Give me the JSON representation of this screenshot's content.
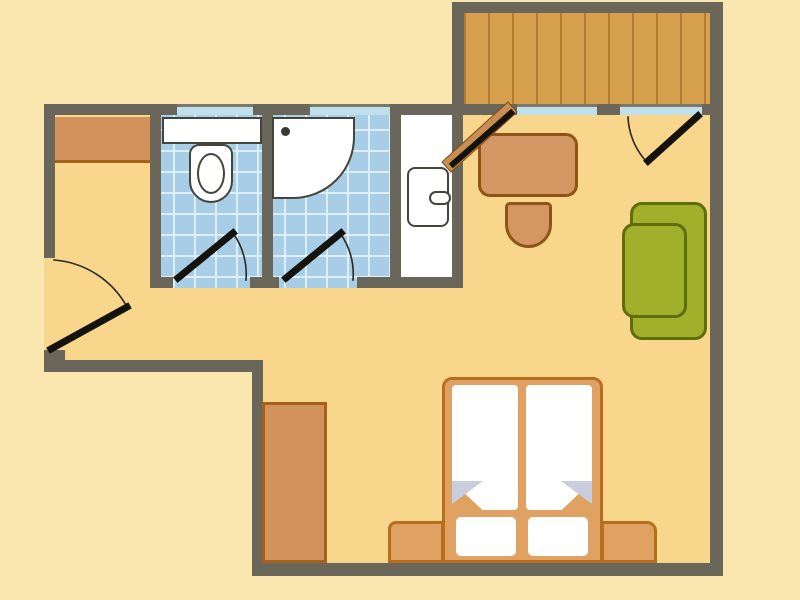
{
  "colors": {
    "outside": "#FAE7AF",
    "floor": "#F8D78C",
    "wall": "#6A675A",
    "window": "#BFE0EB",
    "tile": "#A7CDE7",
    "tile_line": "#DCEFFA",
    "wood": "#D7A04F",
    "wood_line": "#B07C2F",
    "white": "#FFFFFF",
    "fixture_outline": "#45443C",
    "furniture_orange": "#D2935B",
    "furniture_outline": "#A5611C",
    "desk_fill": "#D49663",
    "desk_outline": "#8F5516",
    "bed_frame": "#DFA263",
    "bed_outline": "#B96E1F",
    "sofa_green": "#A0B02A",
    "sofa_outline": "#5F6D0D",
    "door_leaf": "#15130D",
    "arc": "#2A2820",
    "fold": "#C9CEDE",
    "door_panel": "#C98E52",
    "door_panel_outline": "#7A4B15"
  },
  "floor_plan": {
    "rooms": [
      {
        "name": "apartment-floor",
        "surface": "",
        "x": 0,
        "y": 0,
        "w": 800,
        "h": 600,
        "fill": "floor",
        "style": {
          "clipPath": "polygon(55px 115px, 714px 115px, 714px 566px, 252px 566px, 252px 360px, 55px 360px, 55px 350px, 44px 350px, 44px 258px, 55px 258px)"
        }
      },
      {
        "name": "wc-room-tiles",
        "surface": "tiles",
        "x": 161,
        "y": 115,
        "w": 101,
        "h": 173
      },
      {
        "name": "shower-room-tiles",
        "surface": "tiles",
        "x": 272,
        "y": 115,
        "w": 118,
        "h": 173
      },
      {
        "name": "vanity-room",
        "surface": "",
        "x": 401,
        "y": 115,
        "w": 51,
        "h": 173,
        "fill": "white"
      },
      {
        "name": "balcony-deck",
        "surface": "wood",
        "x": 464,
        "y": 13,
        "w": 246,
        "h": 91
      }
    ],
    "walls": [
      {
        "name": "wall-top-left-a",
        "x": 44,
        "y": 104,
        "w": 133,
        "h": 11
      },
      {
        "name": "wall-top-nub-1",
        "x": 253,
        "y": 104,
        "w": 57,
        "h": 11
      },
      {
        "name": "wall-top-left-b",
        "x": 390,
        "y": 104,
        "w": 76,
        "h": 11
      },
      {
        "name": "wall-room-top-a",
        "x": 466,
        "y": 104,
        "w": 51,
        "h": 11
      },
      {
        "name": "wall-room-top-nub",
        "x": 597,
        "y": 104,
        "w": 23,
        "h": 11
      },
      {
        "name": "wall-room-top-b",
        "x": 702,
        "y": 104,
        "w": 21,
        "h": 11
      },
      {
        "name": "wall-balcony-top",
        "x": 455,
        "y": 2,
        "w": 268,
        "h": 11
      },
      {
        "name": "wall-balcony-left",
        "x": 452,
        "y": 2,
        "w": 12,
        "h": 102
      },
      {
        "name": "wall-right",
        "x": 710,
        "y": 2,
        "w": 13,
        "h": 574
      },
      {
        "name": "wall-left",
        "x": 44,
        "y": 104,
        "w": 11,
        "h": 154
      },
      {
        "name": "wall-entry-stub",
        "x": 44,
        "y": 350,
        "w": 21,
        "h": 22
      },
      {
        "name": "wall-hall-bottom",
        "x": 44,
        "y": 360,
        "w": 219,
        "h": 12
      },
      {
        "name": "wall-mid-vertical",
        "x": 252,
        "y": 360,
        "w": 11,
        "h": 213
      },
      {
        "name": "wall-bottom",
        "x": 252,
        "y": 563,
        "w": 471,
        "h": 13
      },
      {
        "name": "wall-bath-left",
        "x": 150,
        "y": 115,
        "w": 11,
        "h": 173
      },
      {
        "name": "wall-wc-shower",
        "x": 262,
        "y": 115,
        "w": 11,
        "h": 173
      },
      {
        "name": "wall-shower-vanity",
        "x": 390,
        "y": 115,
        "w": 11,
        "h": 173
      },
      {
        "name": "wall-vanity-right",
        "x": 452,
        "y": 115,
        "w": 11,
        "h": 173
      },
      {
        "name": "wall-bath-bottom-a",
        "x": 150,
        "y": 277,
        "w": 23,
        "h": 11
      },
      {
        "name": "wall-bath-bottom-b",
        "x": 250,
        "y": 277,
        "w": 29,
        "h": 11
      },
      {
        "name": "wall-bath-bottom-c",
        "x": 357,
        "y": 277,
        "w": 106,
        "h": 11
      }
    ],
    "windows": [
      {
        "name": "window-wc",
        "x": 177,
        "y": 104,
        "w": 76,
        "h": 11
      },
      {
        "name": "window-shower",
        "x": 310,
        "y": 104,
        "w": 80,
        "h": 11
      },
      {
        "name": "window-balcony-left",
        "x": 517,
        "y": 104,
        "w": 80,
        "h": 11
      },
      {
        "name": "window-balcony-right",
        "x": 620,
        "y": 104,
        "w": 82,
        "h": 11
      }
    ],
    "furniture": [
      {
        "name": "hall-wardrobe",
        "x": 55,
        "y": 117,
        "w": 95,
        "h": 46,
        "fill": "furniture_orange",
        "style": {
          "borderBottom": "3px solid #A5611C"
        }
      },
      {
        "name": "wc-cistern",
        "x": 162,
        "y": 117,
        "w": 100,
        "h": 27,
        "fill": "white",
        "style": {
          "border": "2px solid #45443C"
        }
      },
      {
        "name": "toilet-body",
        "x": 189,
        "y": 144,
        "w": 44,
        "h": 59,
        "fill": "white",
        "style": {
          "border": "2.5px solid #45443C",
          "borderRadius": "10px 10px 22px 22px"
        }
      },
      {
        "name": "toilet-bowl",
        "x": 197,
        "y": 153,
        "w": 28,
        "h": 41,
        "fill": "white",
        "style": {
          "border": "2.5px solid #45443C",
          "borderRadius": "50%"
        }
      },
      {
        "name": "shower-tray",
        "x": 272,
        "y": 117,
        "w": 83,
        "h": 82,
        "fill": "white",
        "style": {
          "border": "2.5px solid #45443C",
          "borderBottomRightRadius": "62px"
        }
      },
      {
        "name": "shower-drain",
        "x": 281,
        "y": 127,
        "w": 9,
        "h": 9,
        "fill": "#3A382E",
        "style": {
          "borderRadius": "50%"
        }
      },
      {
        "name": "vanity-unit",
        "x": 407,
        "y": 167,
        "w": 42,
        "h": 60,
        "fill": "white",
        "style": {
          "border": "2.5px solid #45443C",
          "borderRadius": "8px"
        }
      },
      {
        "name": "vanity-handle",
        "x": 429,
        "y": 191,
        "w": 22,
        "h": 14,
        "fill": "white",
        "style": {
          "border": "2.5px solid #45443C",
          "borderRadius": "8px"
        }
      },
      {
        "name": "desk",
        "x": 478,
        "y": 133,
        "w": 100,
        "h": 64,
        "fill": "desk_fill",
        "style": {
          "border": "3px solid #8F5516",
          "borderRadius": "12px"
        }
      },
      {
        "name": "desk-chair",
        "x": 505,
        "y": 202,
        "w": 47,
        "h": 46,
        "fill": "desk_fill",
        "style": {
          "border": "3px solid #8F5516",
          "borderRadius": "5px 5px 24px 24px"
        }
      },
      {
        "name": "daybed-back-cushion",
        "x": 630,
        "y": 202,
        "w": 77,
        "h": 138,
        "fill": "sofa_green",
        "style": {
          "border": "3px solid #5F6D0D",
          "borderRadius": "12px"
        }
      },
      {
        "name": "daybed-front-cushion",
        "x": 622,
        "y": 223,
        "w": 65,
        "h": 95,
        "fill": "sofa_green",
        "style": {
          "border": "3px solid #5F6D0D",
          "borderRadius": "12px"
        }
      },
      {
        "name": "bottom-wardrobe",
        "x": 262,
        "y": 402,
        "w": 65,
        "h": 161,
        "fill": "furniture_orange",
        "style": {
          "border": "3px solid #A5611C"
        }
      },
      {
        "name": "bed-bench-left",
        "x": 388,
        "y": 521,
        "w": 56,
        "h": 42,
        "fill": "bed_frame",
        "style": {
          "border": "3px solid #B96E1F",
          "borderRadius": "8px 0 0 0"
        }
      },
      {
        "name": "bed-bench-right",
        "x": 601,
        "y": 521,
        "w": 56,
        "h": 42,
        "fill": "bed_frame",
        "style": {
          "border": "3px solid #B96E1F",
          "borderRadius": "0 10px 0 0"
        }
      },
      {
        "name": "bed-frame",
        "x": 442,
        "y": 377,
        "w": 161,
        "h": 186,
        "fill": "bed_frame",
        "style": {
          "border": "3px solid #B96E1F",
          "borderRadius": "10px 10px 0 0"
        }
      },
      {
        "name": "mattress-left",
        "x": 452,
        "y": 385,
        "w": 66,
        "h": 125,
        "fill": "white",
        "style": {
          "borderRadius": "4px",
          "clipPath": "polygon(0 0,100% 0,100% 100%,46% 100%,0 77%)"
        }
      },
      {
        "name": "mattress-right",
        "x": 526,
        "y": 385,
        "w": 66,
        "h": 125,
        "fill": "white",
        "style": {
          "borderRadius": "4px",
          "clipPath": "polygon(0 0,100% 0,100% 77%,54% 100%,0 100%)"
        }
      },
      {
        "name": "sheet-fold-left",
        "x": 452,
        "y": 481,
        "w": 31,
        "h": 23,
        "fill": "fold",
        "style": {
          "clipPath": "polygon(0 0,100% 0,0 100%)"
        }
      },
      {
        "name": "sheet-fold-right",
        "x": 561,
        "y": 481,
        "w": 31,
        "h": 23,
        "fill": "fold",
        "style": {
          "clipPath": "polygon(0 0,100% 0,100% 100%)"
        }
      },
      {
        "name": "pillow-left",
        "x": 456,
        "y": 517,
        "w": 60,
        "h": 39,
        "fill": "white",
        "style": {
          "borderRadius": "5px"
        }
      },
      {
        "name": "pillow-right",
        "x": 528,
        "y": 517,
        "w": 60,
        "h": 39,
        "fill": "white",
        "style": {
          "borderRadius": "5px"
        }
      }
    ],
    "doors": [
      {
        "name": "balcony-door-panel",
        "kind": "polygon",
        "points": "451,172 517,112 508,102 442,162",
        "fill": "door_panel",
        "stroke": "door_panel_outline",
        "sw": 1
      },
      {
        "name": "balcony-door-leaf",
        "kind": "line",
        "x1": 453,
        "y1": 164,
        "x2": 511,
        "y2": 113,
        "stroke": "door_leaf",
        "sw": 6
      },
      {
        "name": "entrance-door-arc",
        "kind": "path",
        "d": "M 54 260 A 91 91 0 0 1 127 307",
        "stroke": "arc",
        "sw": 1.6
      },
      {
        "name": "entrance-door-leaf",
        "kind": "line",
        "x1": 51,
        "y1": 349,
        "x2": 127,
        "y2": 307,
        "stroke": "door_leaf",
        "sw": 7
      },
      {
        "name": "wc-door-arc",
        "kind": "path",
        "d": "M 246 280 A 71 71 0 0 0 233 233",
        "stroke": "arc",
        "sw": 1.6
      },
      {
        "name": "wc-door-leaf",
        "kind": "line",
        "x1": 178,
        "y1": 278,
        "x2": 233,
        "y2": 233,
        "stroke": "door_leaf",
        "sw": 7
      },
      {
        "name": "shower-door-arc",
        "kind": "path",
        "d": "M 353 280 A 70 70 0 0 0 340 233",
        "stroke": "arc",
        "sw": 1.6
      },
      {
        "name": "shower-door-leaf",
        "kind": "line",
        "x1": 286,
        "y1": 278,
        "x2": 341,
        "y2": 233,
        "stroke": "door_leaf",
        "sw": 7
      },
      {
        "name": "window-door-arc",
        "kind": "path",
        "d": "M 628 117 A 69 69 0 0 0 646 161",
        "stroke": "arc",
        "sw": 1.6
      },
      {
        "name": "window-door-leaf",
        "kind": "line",
        "x1": 648,
        "y1": 161,
        "x2": 698,
        "y2": 116,
        "stroke": "door_leaf",
        "sw": 7
      }
    ]
  }
}
